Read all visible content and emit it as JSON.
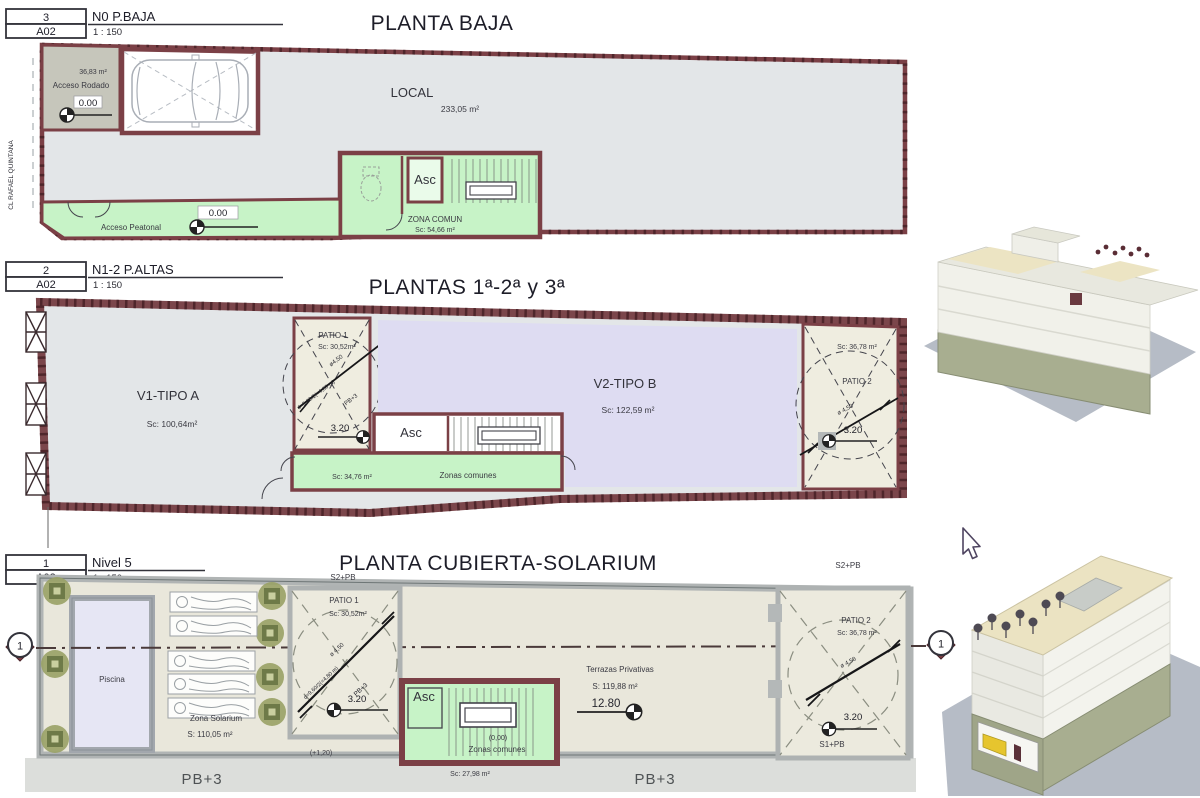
{
  "colors": {
    "wall_maroon": "#7b4046",
    "room_gray": "#e3e6e8",
    "common_green": "#c7f3c7",
    "dwelling_lavender": "#dedcf2",
    "patio_beige": "#efede0",
    "roof_beige": "#e9e7db",
    "roof_wall_gray": "#b0b4b4",
    "planter_olive": "#99a165",
    "render_ground": "#b6bcc6",
    "render_base": "#a8ae90",
    "render_cream": "#ece4c3"
  },
  "plans": {
    "baja": {
      "ref_num": "3",
      "ref_label": "N0 P.BAJA",
      "sheet": "A02",
      "scale": "1 : 150",
      "title": "PLANTA BAJA",
      "street": "CL RAFAEL QUINTANA",
      "garage_area": "36,83 m²",
      "garage_label": "Acceso Rodado",
      "garage_level": "0.00",
      "local_label": "LOCAL",
      "local_area": "233,05 m²",
      "asc": "Asc",
      "zona_comun_label": "ZONA COMUN",
      "zona_comun_area": "Sc: 54,66 m²",
      "peatonal_label": "Acceso Peatonal",
      "peatonal_level": "0.00"
    },
    "altas": {
      "ref_num": "2",
      "ref_label": "N1-2 P.ALTAS",
      "sheet": "A02",
      "scale": "1 : 150",
      "title": "PLANTAS 1ª-2ª y 3ª",
      "v1_label": "V1-TIPO A",
      "v1_area": "Sc: 100,64m²",
      "v2_label": "V2-TIPO B",
      "v2_area": "Sc: 122,59 m²",
      "patio1_label": "PATIO 1",
      "patio1_area": "Sc: 30,52m²",
      "patio1_dim1": "ø4,50",
      "patio1_dim2": "d=9,60/2(=4,80 m)",
      "patio1_dim3": "PB+3",
      "patio1_level": "3.20",
      "asc": "Asc",
      "comunes_area": "Sc: 34,76 m²",
      "comunes_label": "Zonas comunes",
      "patio2_label": "PATIO 2",
      "patio2_area": "Sc: 36,78 m²",
      "patio2_dim": "ø 4,50",
      "patio2_level": "3.20"
    },
    "solarium": {
      "ref_num": "1",
      "ref_label": "Nivel 5",
      "sheet": "A02",
      "scale": "1 : 150",
      "title": "PLANTA CUBIERTA-SOLARIUM",
      "section_mark": "1",
      "piscina_label": "Piscina",
      "solarium_label": "Zona Solarium",
      "solarium_area": "S: 110,05 m²",
      "s2pb_left": "S2+PB",
      "patio1_label": "PATIO 1",
      "patio1_area": "Sc: 30,52m²",
      "patio1_dim1": "ø 4,50",
      "patio1_dim2": "d=9,60/2(=4,80 m)",
      "patio1_dim3": "PB+3",
      "patio1_level": "3.20",
      "patio1_plus": "(+1,20)",
      "asc": "Asc",
      "comunes_zero": "(0,00)",
      "comunes_label": "Zonas comunes",
      "comunes_area": "Sc: 27,98 m²",
      "terrazas_label": "Terrazas Privativas",
      "terrazas_area": "S: 119,88 m²",
      "terrazas_level": "12.80",
      "patio2_label": "PATIO 2",
      "patio2_area": "Sc: 36,78 m²",
      "patio2_dim": "ø 4,50",
      "patio2_level": "3.20",
      "s1pb": "S1+PB",
      "s2pb_right": "S2+PB",
      "pb3_left": "PB+3",
      "pb3_right": "PB+3"
    }
  }
}
